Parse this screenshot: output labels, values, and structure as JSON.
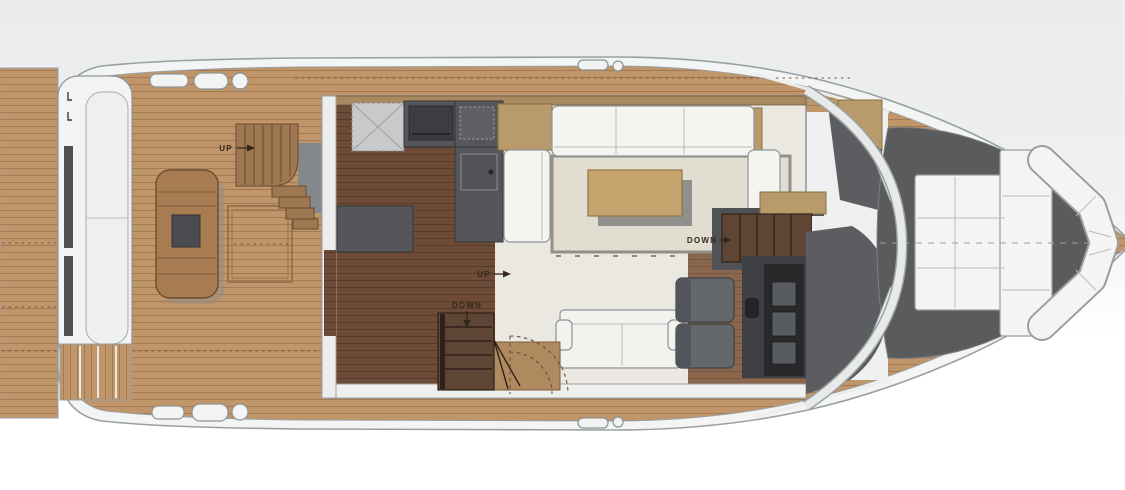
{
  "diagram": {
    "kind": "yacht-main-deck-floor-plan"
  },
  "labels": {
    "aft_deck_stairs": "UP",
    "salon_stairs": "DOWN",
    "companionway_up": "UP",
    "companionway_down": "DOWN"
  },
  "colors": {
    "teak": "#bf9569",
    "darkwood": "#6d4b37",
    "helmwood": "#8a674c",
    "hull": "#f3f4f4",
    "outline": "#9aa0a2",
    "cabin_floor": "#eae8e1",
    "galley_counter": "#54565a",
    "appliance": "#3b3d40",
    "sofa_white": "#f4f4f1",
    "rug": "#e1ded1",
    "rug_border": "#938f86",
    "cabinet_tan": "#b99a6a",
    "table_tan": "#c6a46d",
    "shadow": "#8f8f8c",
    "table_aft": "#a87c53",
    "stair_wood": "#9d7850",
    "stair_dark": "#5f4534",
    "deck_gray": "#595b5d",
    "dash_gray": "#5b5d60",
    "seat_gray": "#64676b",
    "console": "#3e4043",
    "panel": "#28292b",
    "screen": "#585b5f",
    "settee": "#f2f2ef",
    "label_ink": "#35271a",
    "arc_brown": "#6e4f36",
    "wall_tan": "#a9895f",
    "bulkhead": "#eceded"
  }
}
